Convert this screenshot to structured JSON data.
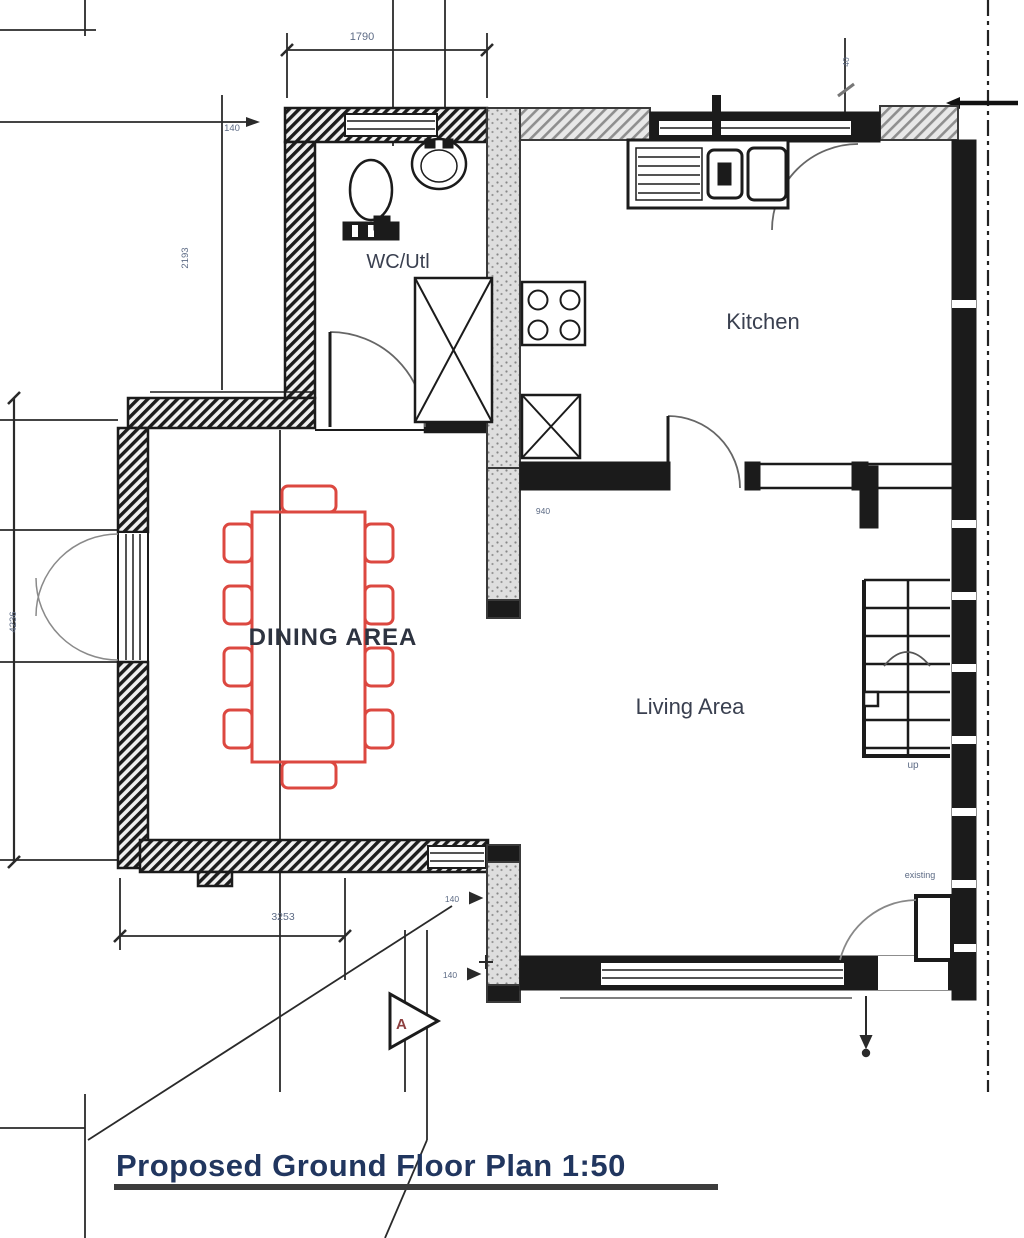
{
  "plan": {
    "title": "Proposed Ground Floor Plan 1:50",
    "labels": {
      "wc": "WC/Utl",
      "kitchen": "Kitchen",
      "dining": "DINING AREA",
      "living": "Living Area",
      "up": "up",
      "existing": "existing",
      "marker_a": "A"
    },
    "dimensions": {
      "top_width": "1790",
      "wall_140_top": "140",
      "left_upper": "2193",
      "left_lower": "4236",
      "bottom_width": "3253",
      "opening": "940",
      "small_40": "40",
      "wall_140_mid": "140",
      "wall_140_low": "140"
    },
    "colors": {
      "furniture_red": "#dc4840",
      "dimension_text": "#5d6b85",
      "title_text": "#21365f",
      "line": "#1f1f1f",
      "existing_wall_gray": "#9a9a9a"
    }
  }
}
